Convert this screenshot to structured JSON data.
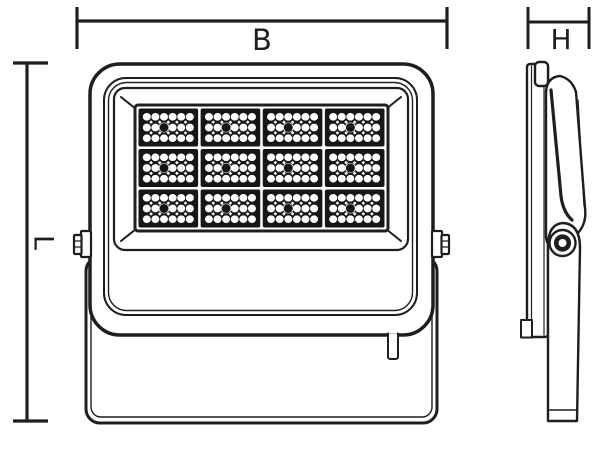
{
  "diagram": {
    "type": "technical-drawing",
    "subject": "led-floodlight",
    "dimensions": {
      "width_label": "B",
      "height_label": "L",
      "depth_label": "H"
    },
    "led_modules": {
      "columns": 4,
      "rows": 3,
      "total_modules": 12,
      "leds_per_module": {
        "columns": 6,
        "rows": 3
      },
      "center_dot": {
        "row": 2,
        "column": 3
      }
    },
    "colors": {
      "line": "#1e1e1e",
      "background": "#ffffff",
      "led_panel": "#161616",
      "led_circle": "#ffffff"
    }
  }
}
